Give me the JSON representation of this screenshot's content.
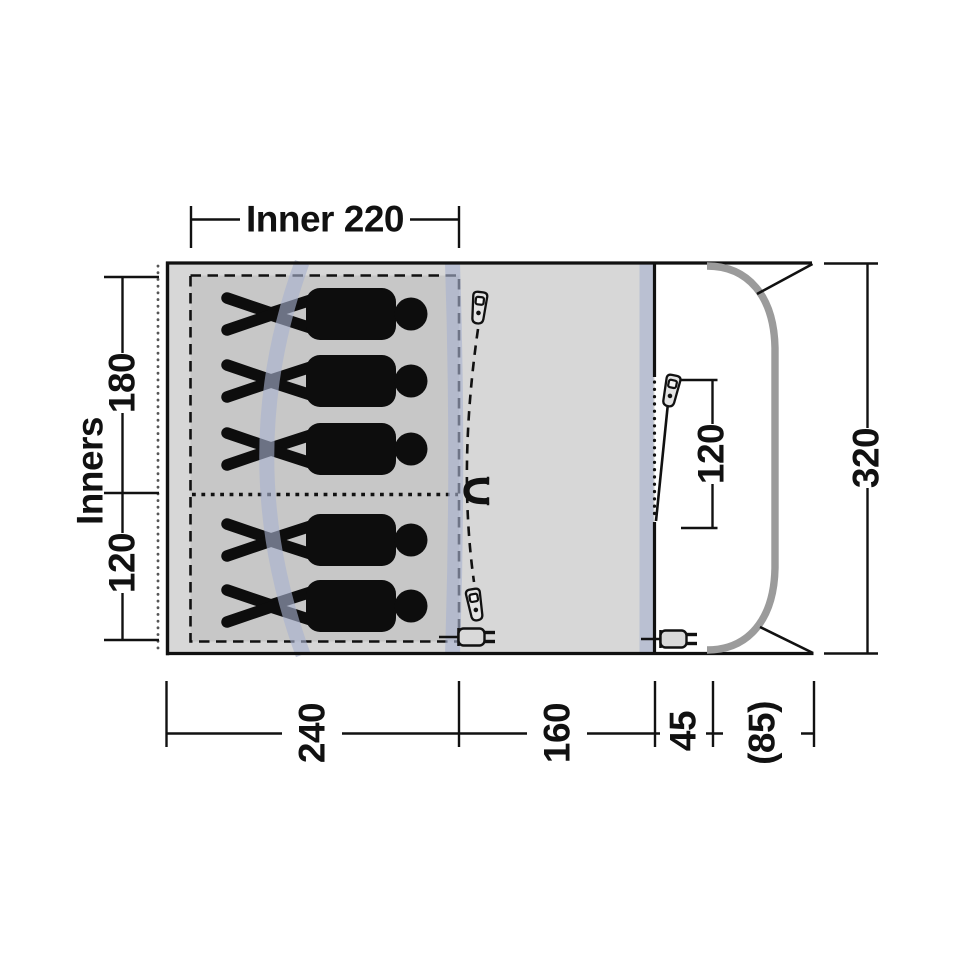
{
  "title": "Tent floor plan – top view",
  "dims": {
    "inner_width": "Inner 220",
    "left_rear_depth": "180",
    "left_front_depth": "120",
    "left_axis_label": "Inners",
    "right_total_depth": "320",
    "front_door_height": "120",
    "bottom_inner_length": "240",
    "bottom_porch_length": "160",
    "bottom_front_length": "45",
    "bottom_awning_length": "(85)"
  },
  "people": {
    "count": 5,
    "rear_bedroom": 3,
    "front_bedroom": 2
  },
  "icons": {
    "zipper_pull": "zipper-pull-icon",
    "magnet": "magnet-door-tieback-icon",
    "power_plug": "electric-hookup-plug-icon",
    "person": "sleeping-person-silhouette"
  },
  "colors": {
    "floor": "#d7d7d7",
    "inner_floor": "#c7c7c7",
    "pole_sleeve": "rgba(168,178,206,0.62)",
    "awning_pole": "#9b9b9b",
    "line": "#111111",
    "silhouette": "#0d0d0d"
  }
}
